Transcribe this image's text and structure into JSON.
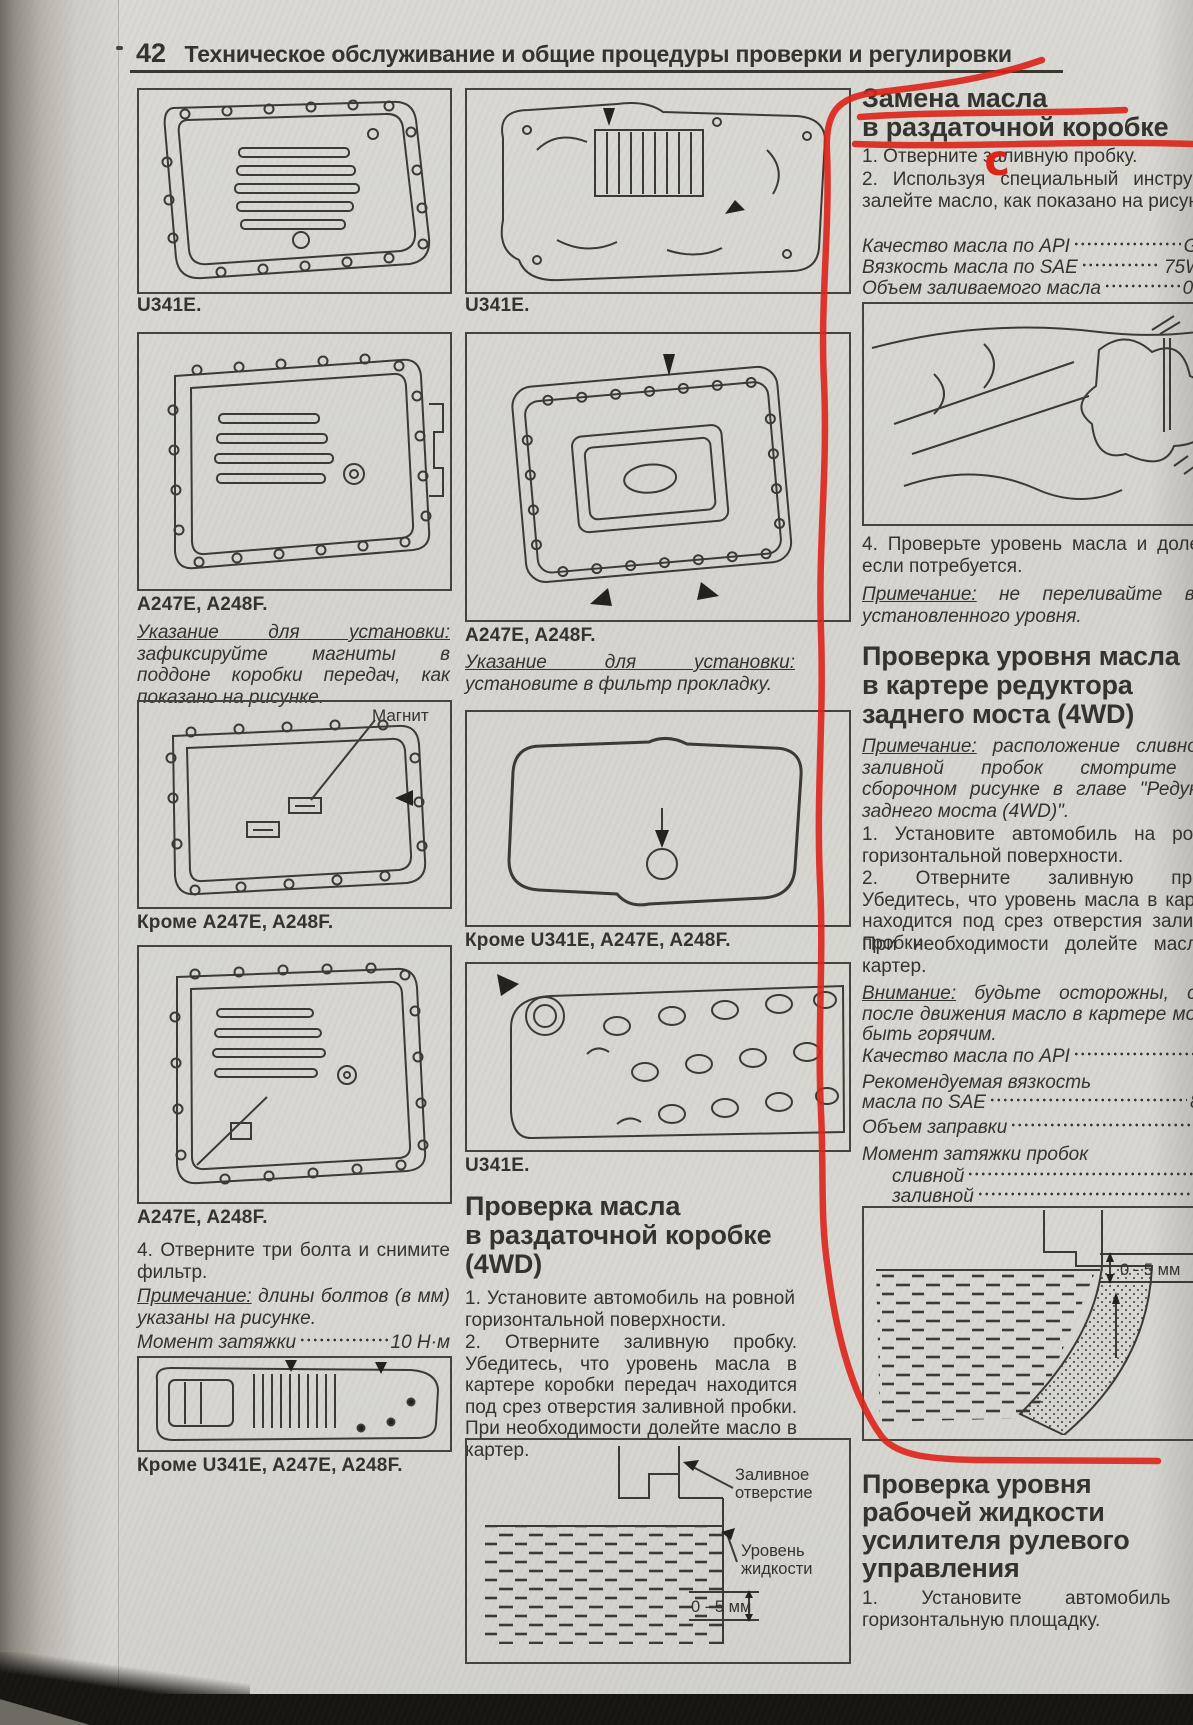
{
  "colors": {
    "paper": "#d7d6d1",
    "ink": "#34322d",
    "red_annotation": "#de2318"
  },
  "header": {
    "page_number": "42",
    "title": "Техническое обслуживание и общие процедуры проверки и регулировки"
  },
  "left": {
    "fig1_caption": "U341E.",
    "fig2_caption": "A247E, A248F.",
    "install_label": "Указание для установки:",
    "install_text": " зафиксируйте магниты в поддоне коробки передач, как показано на рисунке.",
    "magnet_label": "Магнит",
    "fig3_caption": "Кроме A247E, A248F.",
    "fig4_caption": "A247E, A248F.",
    "step4": "4. Отверните три болта и снимите фильтр.",
    "note_label": "Примечание:",
    "note_text": " длины болтов (в мм) указаны на рисунке.",
    "torque_label": "Момент затяжки",
    "torque_value": "10 Н·м",
    "fig5_caption": "Кроме U341E, A247E, A248F."
  },
  "middle": {
    "fig1_caption": "U341E.",
    "fig2_caption": "A247E, A248F.",
    "install_label": "Указание для установки:",
    "install_text": " установите в фильтр прокладку.",
    "fig3_caption": "Кроме U341E, A247E, A248F.",
    "fig4_caption": "U341E.",
    "section_title": "Проверка масла\nв раздаточной коробке\n(4WD)",
    "step1": "1. Установите автомобиль на ровной горизонтальной поверхности.",
    "step2": "2. Отверните заливную пробку. Убедитесь, что уровень масла в картере коробки передач находится под срез отверстия заливной пробки. При необходимости долейте масло в картер.",
    "diagram": {
      "fill_label_1": "Заливное",
      "fill_label_2": "отверстие",
      "level_label_1": "Уровень",
      "level_label_2": "жидкости",
      "gap_label": "0 - 5 мм"
    }
  },
  "right": {
    "s1": {
      "title": "Замена масла\nв раздаточной коробке",
      "step1": "1. Отверните заливную пробку.",
      "step2": "2. Используя специальный инструмент залейте масло, как показано на рисунке.",
      "spec_api_label": "Качество масла по API",
      "spec_api_value": "GL",
      "spec_sae_label": "Вязкость масла по SAE",
      "spec_sae_value": "75W-",
      "spec_vol_label": "Объем заливаемого масла",
      "spec_vol_value": "0,9",
      "step4": "4. Проверьте уровень масла и долейте, если потребуется.",
      "note_label": "Примечание:",
      "note_text": " не переливайте выше установленного уровня."
    },
    "s2": {
      "title": "Проверка уровня масла\nв картере редуктора\nзаднего моста (4WD)",
      "note_label": "Примечание:",
      "note_text": " расположение сливной и заливной пробок смотрите на сборочном рисунке в главе \"Редуктор заднего моста (4WD)\".",
      "step1": "1. Установите автомобиль на ровной горизонтальной поверхности.",
      "step2": "2. Отверните заливную пробку. Убедитесь, что уровень масла в картере находится под срез отверстия заливной пробки.",
      "step2b": "При необходимости долейте масло в картер.",
      "warn_label": "Внимание:",
      "warn_text": " будьте осторожны, сразу после движения масло в картере может быть горячим.",
      "spec_api_label": "Качество масла по API",
      "spec_api_value": "GL",
      "visc_line": "Рекомендуемая вязкость",
      "spec_sae_label": "масла по SAE",
      "spec_sae_value": "85W-",
      "spec_vol_label": "Объем заправки",
      "spec_vol_value": "0,5",
      "torque_header": "Момент затяжки пробок",
      "spec_drain_label": "сливной",
      "spec_drain_value": "39 Н",
      "spec_fill_label": "заливной",
      "spec_fill_value": "98 Н",
      "gap_label": "0 - 5 мм"
    },
    "s3": {
      "title": "Проверка уровня\nрабочей жидкости\nусилителя рулевого\nуправления",
      "step1": "1. Установите автомобиль на горизонтальную площадку."
    }
  },
  "annotation": {
    "letter": "с"
  }
}
